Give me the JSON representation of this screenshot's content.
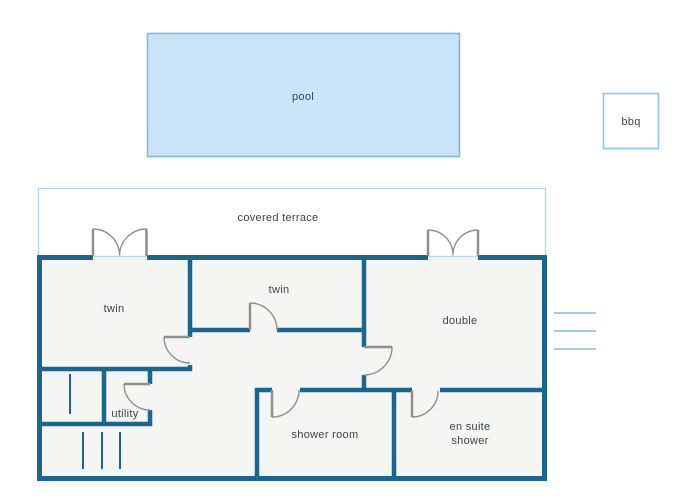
{
  "diagram_type": "floor-plan",
  "colors": {
    "wall": "#19678f",
    "room_fill": "#f5f5f4",
    "door": "#8f8f8f",
    "pool_fill": "#c9e4f7",
    "pool_border": "#7cbbe0",
    "terrace_border": "#b3d7ec",
    "bbq_border": "#8fc7e9",
    "steps": "#a3cde4",
    "text": "#3a454c",
    "background": "#ffffff"
  },
  "outdoor": {
    "pool": {
      "label": "pool"
    },
    "bbq": {
      "label": "bbq"
    },
    "terrace": {
      "label": "covered terrace"
    }
  },
  "rooms": [
    {
      "name": "twin-left",
      "label": "twin"
    },
    {
      "name": "twin-center",
      "label": "twin"
    },
    {
      "name": "double",
      "label": "double"
    },
    {
      "name": "utility",
      "label": "utility"
    },
    {
      "name": "shower-room",
      "label": "shower room"
    },
    {
      "name": "en-suite-shower",
      "label": "en suite shower",
      "label_lines": [
        "en suite",
        "shower"
      ]
    }
  ]
}
